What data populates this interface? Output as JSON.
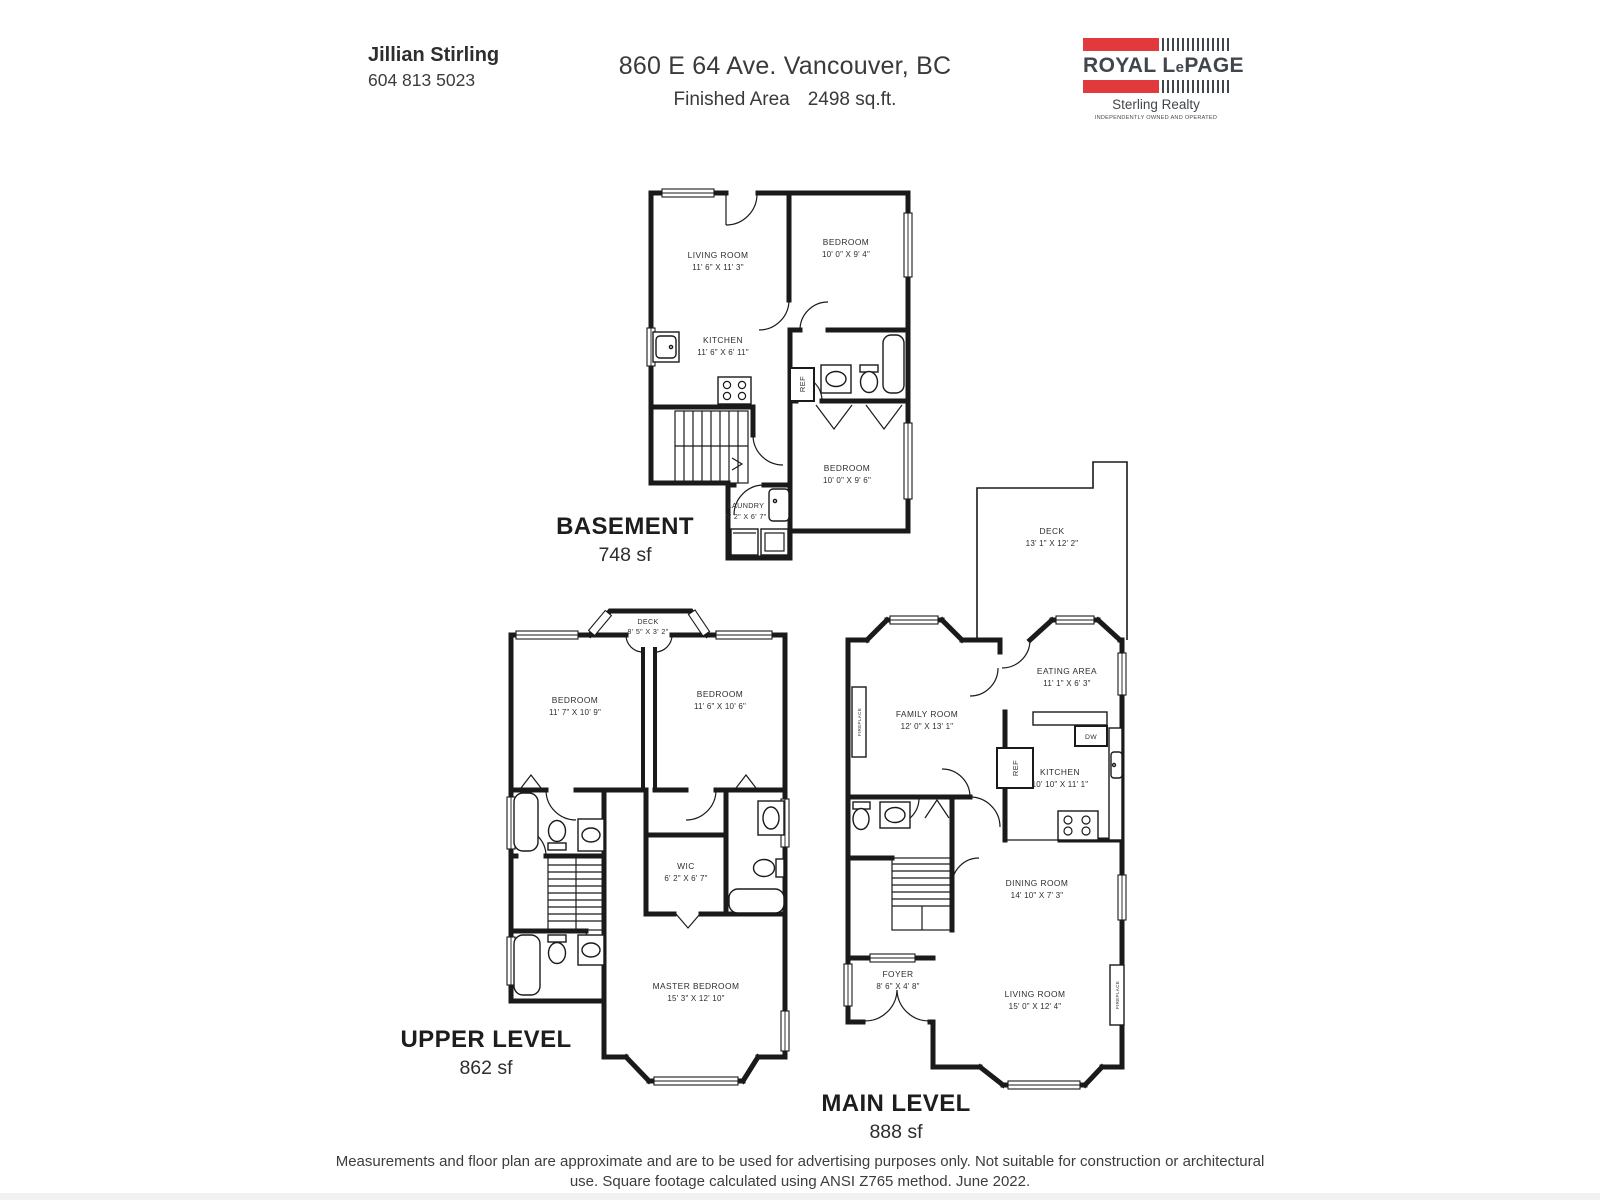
{
  "colors": {
    "logo_red": "#E23A3C",
    "logo_gray": "#41464C",
    "plan_ink": "#1a1a1a"
  },
  "header": {
    "agent": {
      "name": "Jillian Stirling",
      "phone": "604 813 5023"
    },
    "address": "860 E 64 Ave. Vancouver, BC",
    "finished_area": {
      "label": "Finished Area",
      "value": "2498 sq.ft."
    },
    "logo": {
      "part1": "ROYAL L",
      "part2": "e",
      "part3": "PAGE",
      "office": "Sterling Realty",
      "tagline": "INDEPENDENTLY OWNED AND OPERATED"
    }
  },
  "floors": {
    "basement": {
      "label": "BASEMENT",
      "area": "748 sf",
      "rooms": [
        {
          "name": "LIVING ROOM",
          "dims": "11' 6\" X 11' 3\""
        },
        {
          "name": "BEDROOM",
          "dims": "10' 0\" X 9' 4\""
        },
        {
          "name": "KITCHEN",
          "dims": "11' 6\" X 6' 11\""
        },
        {
          "name": "BEDROOM",
          "dims": "10' 0\" X 9' 6\""
        },
        {
          "name": "LAUNDRY",
          "dims": "5' 2\" X 6' 7\""
        }
      ],
      "fixtures": {
        "ref": "REF"
      }
    },
    "upper": {
      "label": "UPPER LEVEL",
      "area": "862 sf",
      "rooms": [
        {
          "name": "DECK",
          "dims": "8' 5\" X 3' 2\""
        },
        {
          "name": "BEDROOM",
          "dims": "11' 7\" X 10' 9\""
        },
        {
          "name": "BEDROOM",
          "dims": "11' 6\" X 10' 6\""
        },
        {
          "name": "WIC",
          "dims": "6' 2\" X 6' 7\""
        },
        {
          "name": "MASTER BEDROOM",
          "dims": "15' 3\" X 12' 10\""
        }
      ]
    },
    "main": {
      "label": "MAIN LEVEL",
      "area": "888 sf",
      "rooms": [
        {
          "name": "DECK",
          "dims": "13' 1\" X 12' 2\""
        },
        {
          "name": "EATING AREA",
          "dims": "11' 1\" X 6' 3\""
        },
        {
          "name": "FAMILY ROOM",
          "dims": "12' 0\" X 13' 1\""
        },
        {
          "name": "KITCHEN",
          "dims": "10' 10\" X 11' 1\""
        },
        {
          "name": "DINING ROOM",
          "dims": "14' 10\" X 7' 3\""
        },
        {
          "name": "FOYER",
          "dims": "8' 6\" X 4' 8\""
        },
        {
          "name": "LIVING ROOM",
          "dims": "15' 0\" X 12' 4\""
        }
      ],
      "fixtures": {
        "ref": "REF",
        "dw": "DW",
        "fireplace": "FIREPLACE"
      }
    }
  },
  "footer": {
    "line1": "Measurements and floor plan are approximate and are to be used for advertising purposes only. Not suitable for construction or architectural",
    "line2": "use. Square footage calculated using ANSI Z765 method. June 2022."
  }
}
